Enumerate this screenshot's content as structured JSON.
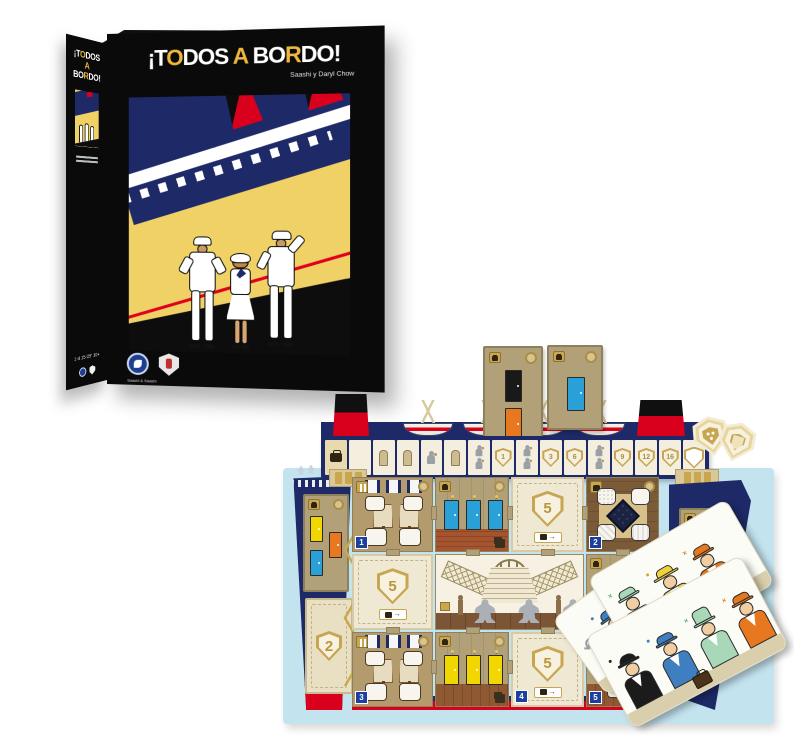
{
  "box": {
    "front": {
      "title": {
        "p1": "¡T",
        "o": "O",
        "p2": "DOS ",
        "a": "A",
        "p3": " BO",
        "r": "R",
        "p4": "DO!"
      },
      "subtitle": "Saashi y Daryl Chow",
      "publisher": "Saashi & Saashi"
    },
    "spine": {
      "title_line1_p1": "¡T",
      "title_line1_o": "O",
      "title_line1_p2": "DOS",
      "title_line2_a": "A",
      "title_line3_p1": "BO",
      "title_line3_r": "R",
      "title_line3_p2": "DO!",
      "stats": {
        "players": "1-4",
        "time": "15-25'",
        "age": "10+"
      }
    }
  },
  "board": {
    "track": {
      "cells": [
        {
          "type": "suitcase-start"
        },
        {
          "type": "empty"
        },
        {
          "type": "figure"
        },
        {
          "type": "figure"
        },
        {
          "type": "porter"
        },
        {
          "type": "figure"
        },
        {
          "type": "porter-double"
        },
        {
          "type": "shield",
          "value": "1"
        },
        {
          "type": "porter-double"
        },
        {
          "type": "shield",
          "value": "3"
        },
        {
          "type": "shield",
          "value": "6"
        },
        {
          "type": "porter-double"
        },
        {
          "type": "shield",
          "value": "9"
        },
        {
          "type": "shield",
          "value": "12"
        },
        {
          "type": "shield",
          "value": "16"
        },
        {
          "type": "shield-blank"
        }
      ]
    },
    "shield_tiles": {
      "bow": "2",
      "row1": "5",
      "left": "5",
      "row3": "5"
    },
    "room_numbers": {
      "dining_top": "1",
      "game_room": "2",
      "dining_bottom": "3",
      "tile_bottom": "4",
      "cabin_bottom_right": "5"
    },
    "rooms": [
      {
        "id": 1,
        "type": "dining-room"
      },
      {
        "id": 2,
        "type": "game-room"
      },
      {
        "id": 3,
        "type": "dining-room"
      },
      {
        "id": 4,
        "type": "promenade-tile"
      },
      {
        "id": 5,
        "type": "cabin-room"
      }
    ],
    "meeples": {
      "count": 3,
      "color": "#aab0b5"
    },
    "door_colors": [
      "#2aa0d8",
      "#f2d600",
      "#e87820",
      "#a8d4b8",
      "#191919"
    ],
    "tokens": {
      "count": 2,
      "shape": "shield",
      "back_emblem_pips": 3
    }
  },
  "cards": {
    "back": {
      "icon": "return-arrow",
      "visible_characters": [
        {
          "id": "woman-blue-hat",
          "mark_color": "#3f7fc0"
        }
      ]
    },
    "middle": {
      "visible_characters": [
        {
          "id": "man-green-hat",
          "mark_color": "#5aa86e"
        },
        {
          "id": "woman-yellow-hat",
          "mark_color": "#d4a520"
        },
        {
          "id": "man-orange-hat",
          "mark_color": "#e87820"
        }
      ]
    },
    "front": {
      "props": [
        "suitcase"
      ],
      "visible_characters": [
        {
          "id": "man-black-bowler",
          "mark_color": "#222222"
        },
        {
          "id": "woman-blue-hat",
          "mark_color": "#3f7fc0"
        },
        {
          "id": "person-green-coat",
          "mark_color": "#5aa86e"
        },
        {
          "id": "man-orange-hat",
          "mark_color": "#e87820"
        }
      ]
    }
  },
  "colors": {
    "navy": "#1e2a68",
    "red": "#d8001d",
    "box_yellow": "#efd166",
    "title_gold": "#efb73e",
    "gold": "#c8a552",
    "sky": "#c3e3ef",
    "cream": "#f3eedd",
    "tan": "#b2a178",
    "meeple_gray": "#aab0b5",
    "door_blue": "#2aa0d8",
    "door_yellow": "#f2d600",
    "door_orange": "#e87820",
    "door_green": "#a8d4b8"
  }
}
